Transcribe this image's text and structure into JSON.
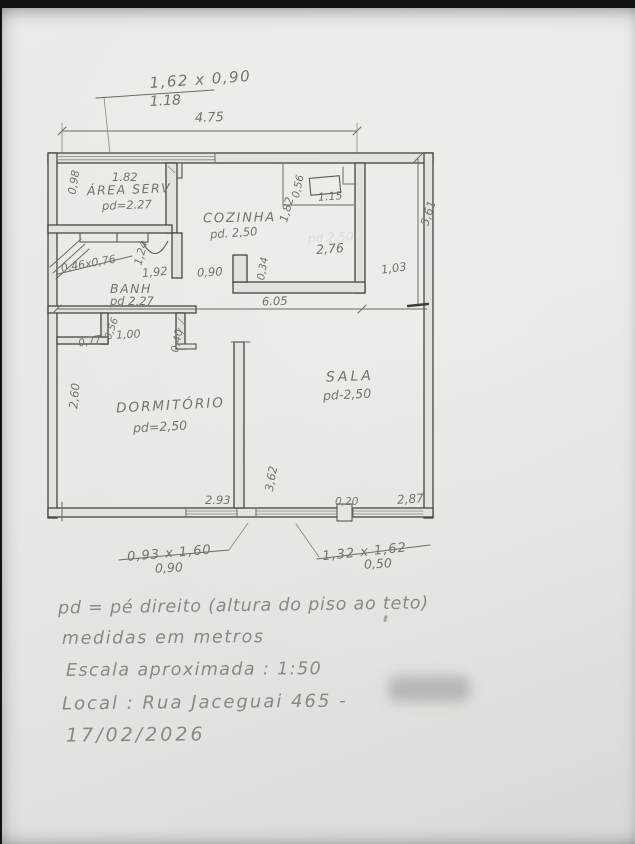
{
  "plan": {
    "top_window": {
      "size": "1,62 x 0,90",
      "sill": "1.18"
    },
    "dims": {
      "d475": "4.75",
      "d561": "5,61",
      "d605": "6.05",
      "d182a": "1.82",
      "d098": "0,98",
      "d056k": "0,56",
      "d115": "1.15",
      "d182k": "1,82",
      "d276": "2,76",
      "d103": "1,03",
      "d4676": "0,46x0,76",
      "d124": "1,24",
      "d192": "1,92",
      "d090k": "0,90",
      "d034": "0,34",
      "d077": "0,77",
      "d056c": "0,56",
      "d100": "1,00",
      "d040": "0,40",
      "d260": "2,60",
      "d362": "3,62",
      "d293": "2.93",
      "d020": "0,20",
      "d287": "2,87"
    },
    "rooms": {
      "area_serv": {
        "name": "ÁREA SERV",
        "pd": "pd=2.27"
      },
      "cozinha": {
        "name": "COZINHA",
        "pd": "pd. 2,50"
      },
      "banh": {
        "name": "BANH",
        "pd": "pd 2,27"
      },
      "dormitorio": {
        "name": "DORMITÓRIO",
        "pd": "pd=2,50"
      },
      "sala": {
        "name": "SALA",
        "pd": "pd-2,50"
      }
    },
    "erased_label": "pd 2,50",
    "windows_bottom": {
      "left": {
        "size": "0,93 x 1,60",
        "sill": "0,90"
      },
      "right": {
        "size": "1,32 x 1,62",
        "sill": "0,50"
      }
    }
  },
  "notes": {
    "legend": "pd = pé direito (altura do piso ao teto)",
    "units": "medidas em metros",
    "scale": "Escala aproximada : 1:50",
    "location": "Local : Rua  Jaceguai  465 -",
    "date": "17/02/2026"
  }
}
